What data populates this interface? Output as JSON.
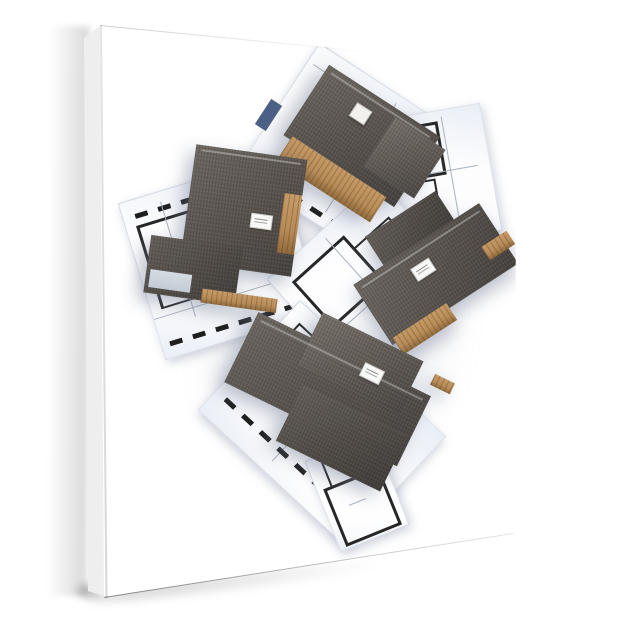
{
  "meta": {
    "type": "product-photo",
    "alt": "White gallery-wrapped canvas print, viewed slightly from the left, showing a 3D rendering of four dark-roofed timber house models standing on overlapping architectural blueprint floor plans; a soft shadow falls along the left side and below the canvas.",
    "background_color": "#ffffff"
  },
  "canvas": {
    "front_color": "#ffffff",
    "side_color": "#f0f0f0",
    "edge_line_color": "rgba(0,0,0,0.25)",
    "shadow_color": "rgba(0,0,0,0.16)"
  },
  "artwork": {
    "subject": "3D house models standing on architecture blueprints",
    "palette": {
      "roof": "#59534e",
      "roof_dark": "#474340",
      "roof_light": "#6e6862",
      "wood": "#b78c58",
      "wood_dark": "#8f6a3c",
      "paper": "#ffffff",
      "paper_tint": "#e9eef6",
      "wall_line": "#262626",
      "thin_line": "#a9b3c0",
      "navy": "#4c6086"
    },
    "houses": [
      {
        "id": "top-house",
        "description": "cross-gabled house with timber walls and white chimney, rotated clockwise, upper centre"
      },
      {
        "id": "left-house",
        "description": "large hip-roof house with lower extension and pale blue wall, centre left"
      },
      {
        "id": "right-house",
        "description": "long gabled house with timber lower walls, rotated counter-clockwise, centre right"
      },
      {
        "id": "bottom-house",
        "description": "sprawling multi-wing roof complex, lower centre"
      }
    ],
    "sheets": [
      {
        "id": "sheet-top",
        "description": "blueprint sheet under top house with navy title block"
      },
      {
        "id": "sheet-right-upper",
        "description": "blueprint sheet with room grid, upper right"
      },
      {
        "id": "sheet-left",
        "description": "blueprint sheet with dashed exterior walls, centre left"
      },
      {
        "id": "sheet-center",
        "description": "blueprint sheet between houses, centre"
      },
      {
        "id": "sheet-bottom",
        "description": "large blueprint sheet under bottom house"
      },
      {
        "id": "sheet-bottom-small",
        "description": "small blueprint sheet with thick-walled room, bottom centre"
      }
    ],
    "labels_note": "tiny illegible specification tags on each roof"
  }
}
